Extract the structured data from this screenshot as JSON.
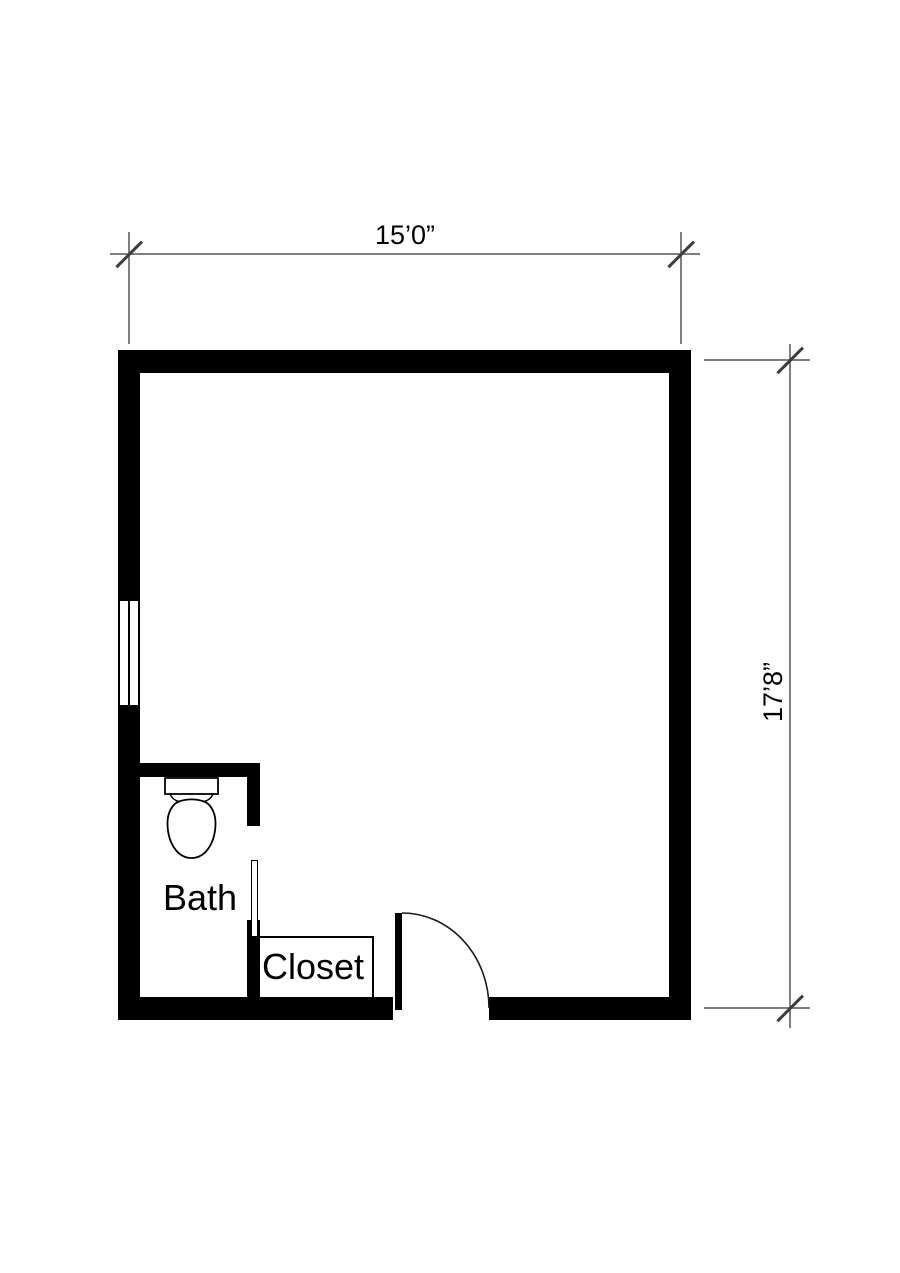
{
  "title": "Room floor plan",
  "dimensions": {
    "width_label": "15’0”",
    "height_label": "17’8”"
  },
  "rooms": {
    "bath_label": "Bath",
    "closet_label": "Closet"
  },
  "fixtures": [
    "toilet",
    "window",
    "entry-door",
    "closet-door"
  ],
  "colors": {
    "wall": "#000000",
    "dimension_line": "#7f7f7f",
    "tick": "#3c3c3c",
    "background": "#ffffff",
    "text": "#000000"
  }
}
